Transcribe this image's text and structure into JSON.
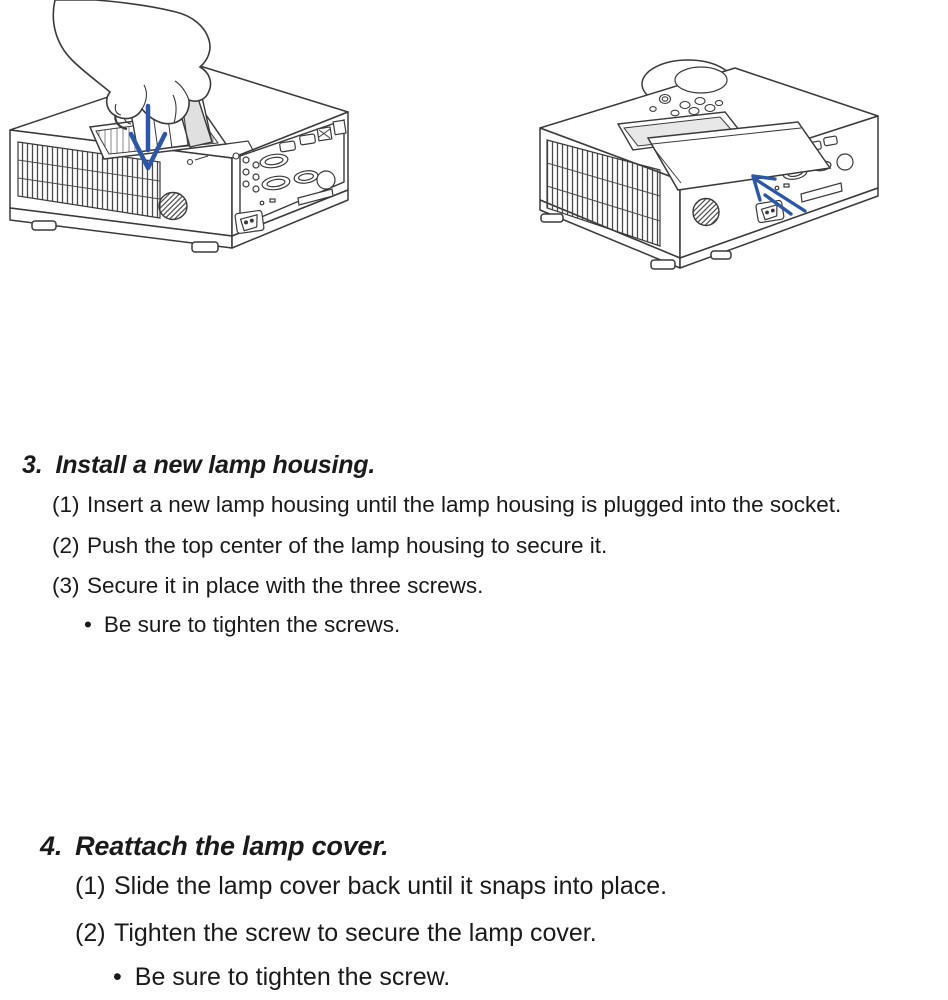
{
  "page": {
    "background": "#ffffff",
    "text_color": "#1a1a1a"
  },
  "figures": {
    "arrow_color": "#2b57a6",
    "install_figure": "hand inserting new lamp housing into projector",
    "reattach_figure": "lamp cover sliding back onto projector"
  },
  "sections": [
    {
      "number": "3.",
      "title": "Install a new lamp housing.",
      "steps": [
        {
          "label": "(1)",
          "text": "Insert a new lamp housing until the lamp housing is plugged into the socket."
        },
        {
          "label": "(2)",
          "text": "Push the top center of the lamp housing to secure it."
        },
        {
          "label": "(3)",
          "text": "Secure it in place with the three screws."
        }
      ],
      "notes": [
        {
          "bullet": "•",
          "text": "Be sure to tighten the screws."
        }
      ]
    },
    {
      "number": "4.",
      "title": "Reattach the lamp cover.",
      "steps": [
        {
          "label": "(1)",
          "text": "Slide the lamp cover back until it snaps into place."
        },
        {
          "label": "(2)",
          "text": "Tighten the screw to secure the lamp cover."
        }
      ],
      "notes": [
        {
          "bullet": "•",
          "text": "Be sure to tighten the screw."
        }
      ]
    }
  ]
}
